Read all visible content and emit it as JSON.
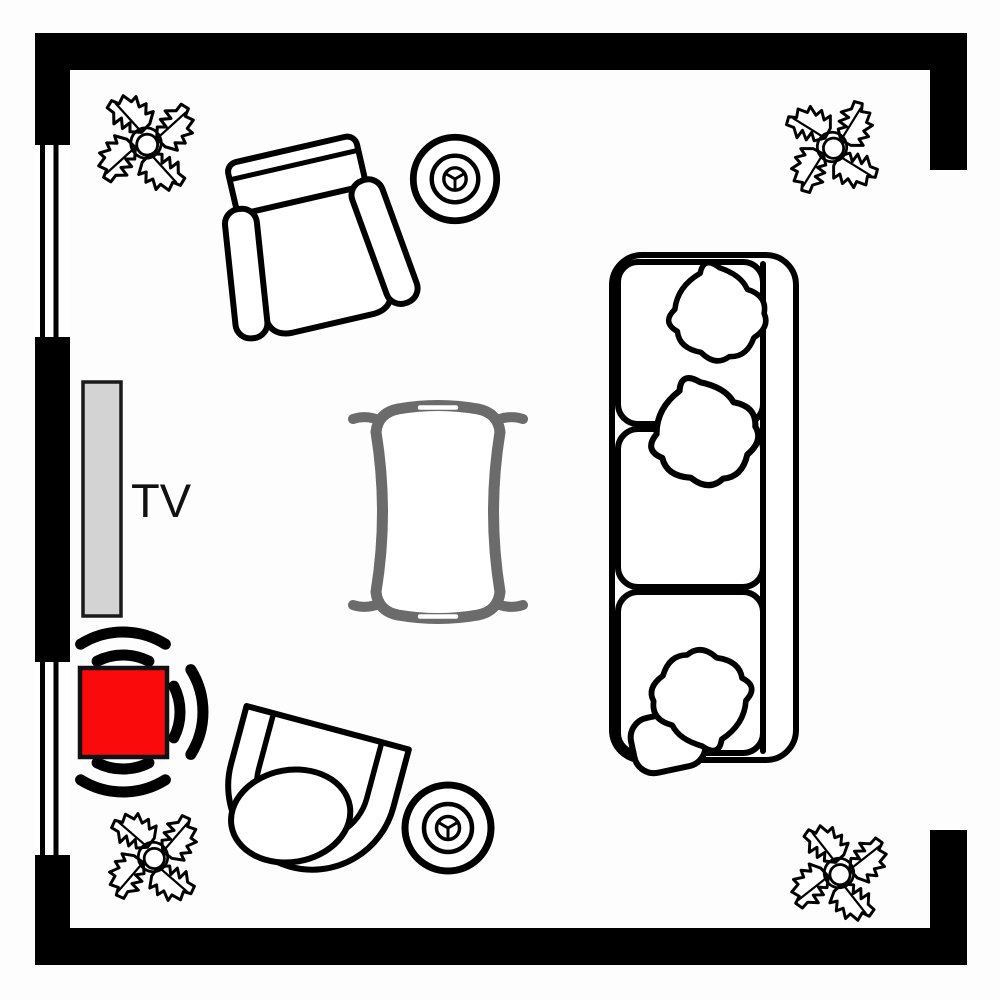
{
  "page": {
    "title": "Living Room Floor Plan"
  },
  "labels": {
    "tv": "TV"
  },
  "colors": {
    "wall": "#000000",
    "outline": "#000000",
    "table": "#6b6b6b",
    "tv_fill": "#d3d3d3",
    "tv_border": "#1a1a1a",
    "speaker": "#fa0a0a"
  },
  "room": {
    "shape": "square",
    "walls": [
      "top",
      "left",
      "bottom",
      "right-partial"
    ],
    "windows": [
      {
        "wall": "left",
        "position": "upper"
      },
      {
        "wall": "left",
        "position": "lower"
      }
    ],
    "opening": {
      "wall": "right",
      "description": "wide wall opening"
    }
  },
  "furniture": [
    {
      "icon": "armchair-icon",
      "area": "top-left"
    },
    {
      "icon": "round-stool-icon",
      "area": "top-center"
    },
    {
      "icon": "sofa-icon",
      "seats": 3,
      "pillows": 3,
      "area": "right"
    },
    {
      "icon": "coffee-table-icon",
      "area": "center",
      "color": "#6b6b6b"
    },
    {
      "icon": "tv-icon",
      "label": "TV",
      "area": "left-wall"
    },
    {
      "icon": "speaker-icon",
      "area": "left",
      "color": "#fa0a0a",
      "sound_wave_sides": 3
    },
    {
      "icon": "tub-chair-icon",
      "area": "bottom-left"
    },
    {
      "icon": "round-stool-icon",
      "area": "bottom-center"
    },
    {
      "icon": "plant-icon",
      "area": "corner-top-left"
    },
    {
      "icon": "plant-icon",
      "area": "corner-top-right"
    },
    {
      "icon": "plant-icon",
      "area": "corner-bottom-left"
    },
    {
      "icon": "plant-icon",
      "area": "corner-bottom-right"
    }
  ]
}
